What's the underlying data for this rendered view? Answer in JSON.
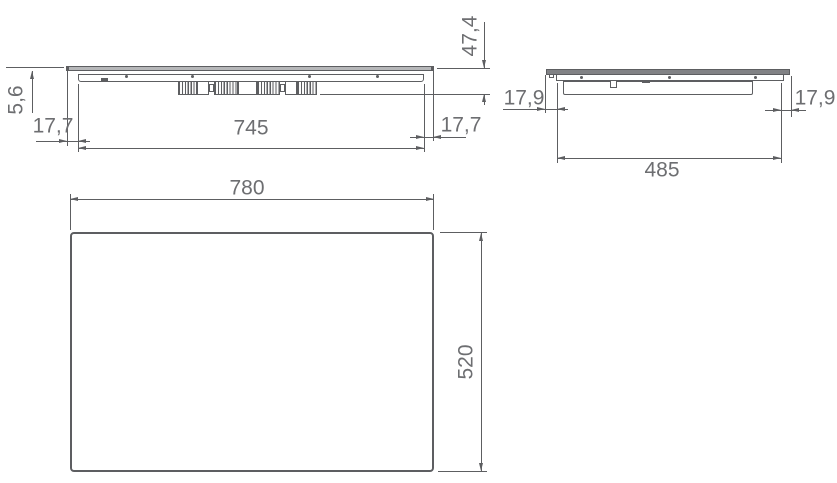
{
  "drawing": {
    "type": "technical-dimension-drawing",
    "colors": {
      "line": "#5d5e61",
      "text": "#6d6e71"
    },
    "views": {
      "front": {
        "glass_thickness": "5,6",
        "overhang_left": "17,7",
        "body_width": "745",
        "overhang_right": "17,7",
        "total_height": "47,4"
      },
      "side": {
        "overhang_left": "17,9",
        "body_depth": "485",
        "overhang_right": "17,9"
      },
      "plan": {
        "width": "780",
        "depth": "520"
      }
    }
  }
}
